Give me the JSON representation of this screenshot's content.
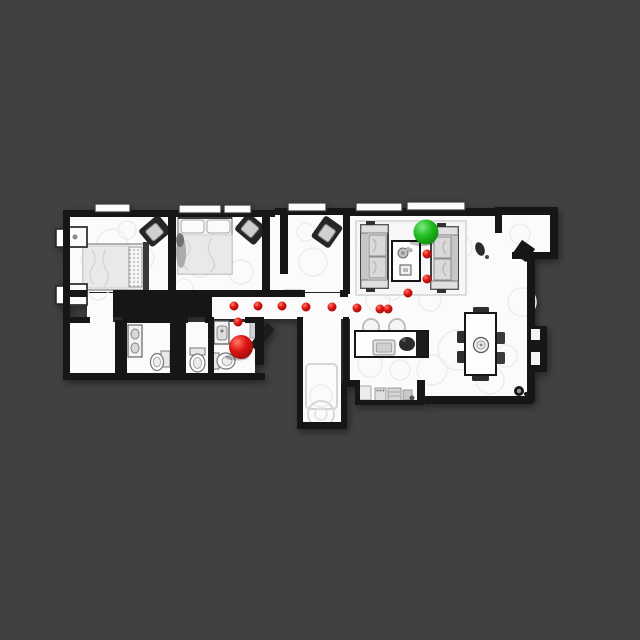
{
  "scene": {
    "description": "Top-down scanned apartment floor plan with a navigation path of red waypoints from a red start sphere to a green goal sphere",
    "background_color": "#414141",
    "floor_color": "#fbfbfb",
    "wall_color": "#121212",
    "scan_ring_color": "#ededed"
  },
  "path": {
    "dot_color": "#dc1414",
    "dot_highlight": "#ff7a62",
    "dot_shade": "#8e0a0a",
    "dot_radius": 4.5,
    "waypoints": [
      [
        238,
        322
      ],
      [
        234,
        306
      ],
      [
        258,
        306
      ],
      [
        282,
        306
      ],
      [
        306,
        307
      ],
      [
        332,
        307
      ],
      [
        357,
        308
      ],
      [
        380,
        309
      ],
      [
        388,
        309
      ],
      [
        408,
        293
      ],
      [
        427,
        279
      ],
      [
        427,
        254
      ]
    ]
  },
  "markers": {
    "start": {
      "name": "start-sphere",
      "x": 241,
      "y": 347,
      "radius": 12,
      "color": "#dc1414",
      "highlight": "#ff7a62",
      "shade": "#8e0a0a"
    },
    "goal": {
      "name": "goal-sphere",
      "x": 426,
      "y": 232,
      "radius": 12.5,
      "color": "#1fbd1f",
      "highlight": "#82e882",
      "shade": "#0d810d"
    }
  },
  "regions": [
    "bedroom-1",
    "bedroom-2",
    "hall",
    "corridor",
    "bathroom",
    "toilet-room",
    "vestibule",
    "laundry-nook",
    "living-room",
    "kitchen",
    "dining-area",
    "entry-alcove"
  ]
}
